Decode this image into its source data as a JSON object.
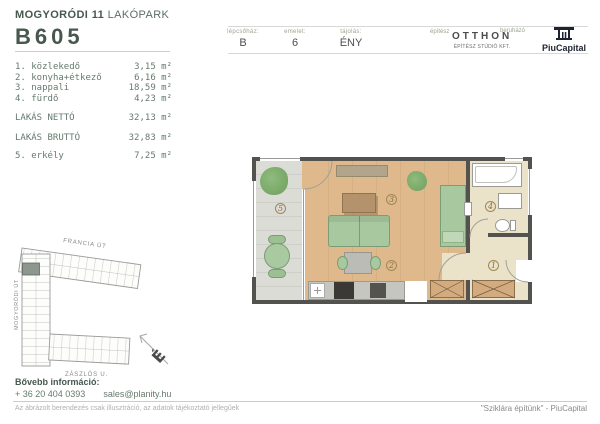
{
  "header": {
    "project": {
      "bold": "MOGYORÓDI 11",
      "light": " LAKÓPARK"
    },
    "unit_id": "B605",
    "meta": [
      {
        "label": "lépcsőház:",
        "value": "B"
      },
      {
        "label": "emelet:",
        "value": "6"
      },
      {
        "label": "tájolás:",
        "value": "ÉNY"
      }
    ],
    "architect": {
      "label": "építész",
      "name": "OTTHON",
      "sub": "ÉPÍTÉSZ STÚDIÓ KFT."
    },
    "developer": {
      "label": "beruházó",
      "name": "PiuCapital"
    }
  },
  "room_list": {
    "items": [
      {
        "num": "1.",
        "name": "közlekedő",
        "area": "3,15 m²"
      },
      {
        "num": "2.",
        "name": "konyha+étkező",
        "area": "6,16 m²"
      },
      {
        "num": "3.",
        "name": "nappali",
        "area": "18,59 m²"
      },
      {
        "num": "4.",
        "name": "fürdő",
        "area": "4,23 m²"
      }
    ],
    "totals": [
      {
        "label": "LAKÁS NETTÓ",
        "area": "32,13 m²"
      },
      {
        "label": "LAKÁS BRUTTÓ",
        "area": "32,83 m²"
      }
    ],
    "extra": {
      "num": "5.",
      "name": "erkély",
      "area": "7,25 m²"
    }
  },
  "floorplan": {
    "room_labels": [
      "1",
      "2",
      "3",
      "4",
      "5"
    ]
  },
  "siteplan": {
    "street_top": "FRANCIA ÚT",
    "street_left": "MOGYORÓDI ÚT",
    "street_bottom": "ZÁSZLÓS U.",
    "compass": "É"
  },
  "footer": {
    "info_label": "Bővebb információ:",
    "phone": "+ 36 20 404 0393",
    "email": "sales@planity.hu",
    "disclaimer": "Az ábrázolt berendezés csak illusztráció, az adatok tájékoztató jellegűek",
    "tagline": "\"Sziklára építünk\" - PiuCapital"
  },
  "colors": {
    "accent_green": "#47584e",
    "wall": "#53524e",
    "wood_floor": "#dfb98c",
    "hall_floor": "#eae3c9",
    "balcony_floor": "#dcdcd7",
    "furniture_green": "#a8c9a0",
    "logo_dark": "#1d2430"
  }
}
